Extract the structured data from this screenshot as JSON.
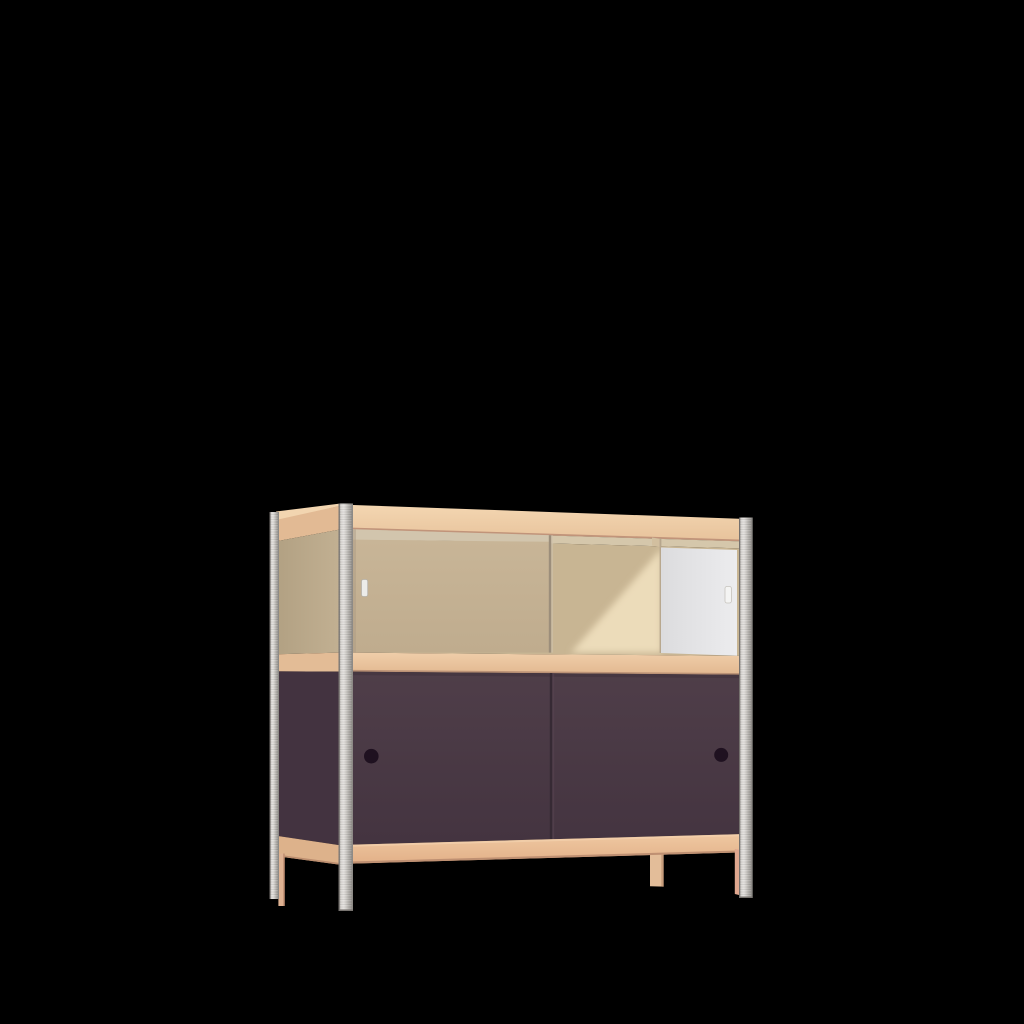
{
  "scene": {
    "kind": "product-render",
    "object": "sideboard cabinet with glass display top, two purple sliding doors and four slim legs",
    "background": "#000000"
  },
  "colors": {
    "background": "#000000",
    "wood_band_top": "#ecc9a3",
    "wood_band_side": "#e2ba94",
    "wood_band_middle": "#e9c39c",
    "wood_band_bottom": "#e9c098",
    "wood_band_side_middle": "#e3bc96",
    "wood_band_side_bottom": "#ddb28b",
    "wood_edge_dark": "#bb9276",
    "top_surface_sliver": "#f2d5b0",
    "ceiling_sliver": "#d5c7ab",
    "glass_top_strip": "#d2c5ad",
    "glass_tint": "#c3b092",
    "glass_edge": "#9c8e7b",
    "interior_shadow": "#c8b593",
    "interior_light": "#ecdcba",
    "partition_line": "#b1a189",
    "white_panel": "#e2e2e4",
    "white_panel_edge": "#b1a189",
    "handle_left": "#ececea",
    "handle_right": "#f4f4f3",
    "door_purple": "#4c3b46",
    "door_purple_side": "#433340",
    "door_seam": "#362a34",
    "finger_hole": "#1f1120",
    "metal_leg_base": "#c3c0bc",
    "metal_leg_edge": "#75716e",
    "wood_leg": "#e3bd99",
    "wood_leg_strip": "#dfb292",
    "wood_leg_strip_right": "#dfa78f",
    "wood_leg_edge": "#c79c7b"
  }
}
